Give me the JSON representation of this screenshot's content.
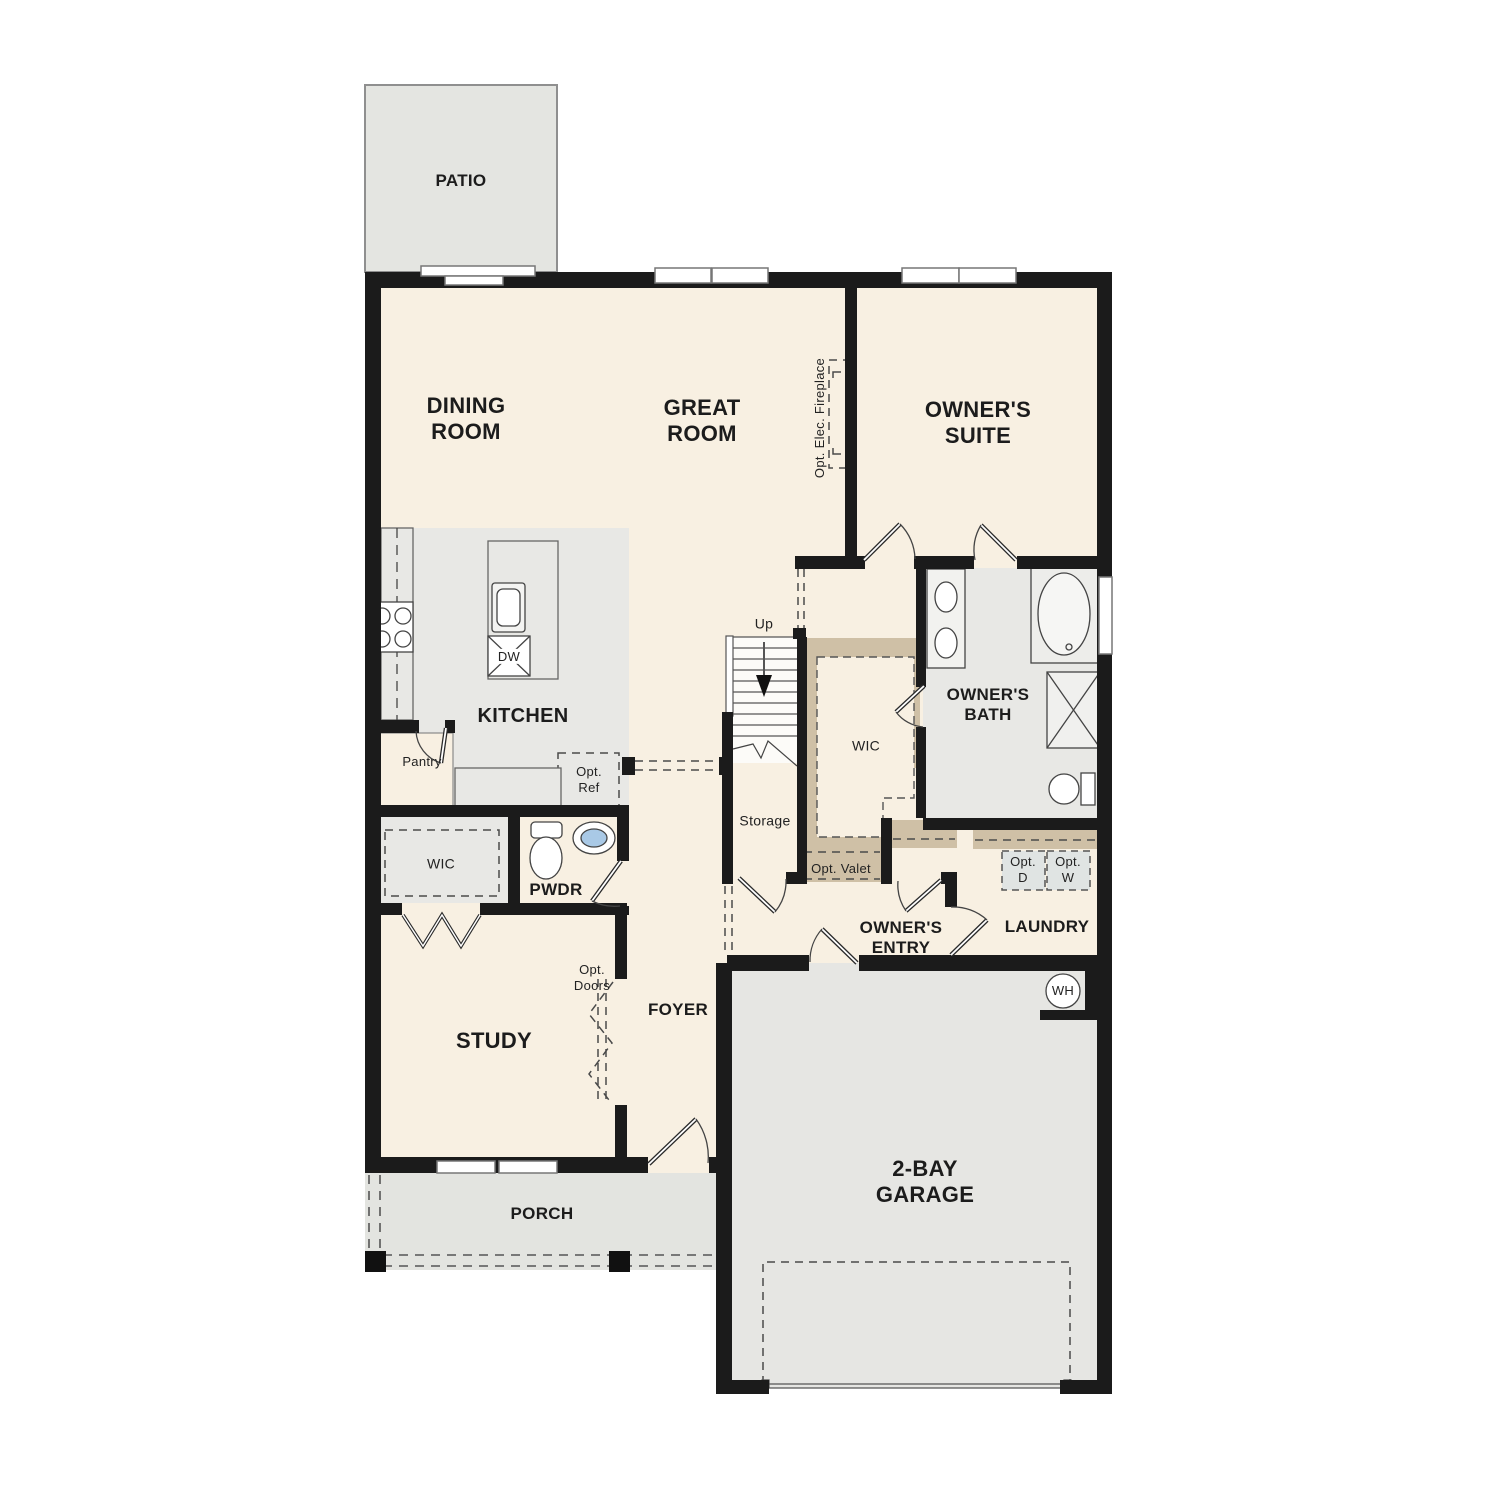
{
  "colors": {
    "wall": "#1b1b1b",
    "floor_main": "#f8f0e2",
    "floor_gray": "#e8e8e5",
    "floor_garage": "#e6e6e3",
    "floor_porch": "#e3e4e0",
    "floor_patio": "#e4e5e1",
    "closet_tan": "#cfc0a6",
    "appliance_box": "#e0e4e3",
    "sink_blue": "#a9c9e6"
  },
  "labels": {
    "patio": "PATIO",
    "dining_room": "DINING\nROOM",
    "great_room": "GREAT\nROOM",
    "owners_suite": "OWNER'S\nSUITE",
    "opt_elec_fireplace": "Opt. Elec. Fireplace",
    "kitchen": "KITCHEN",
    "dw": "DW",
    "pantry": "Pantry",
    "opt_ref": "Opt.\nRef",
    "up": "Up",
    "storage": "Storage",
    "wic_owner": "WIC",
    "opt_valet": "Opt. Valet",
    "owners_bath": "OWNER'S\nBATH",
    "wic_study": "WIC",
    "pwdr": "PWDR",
    "opt_doors": "Opt.\nDoors",
    "study": "STUDY",
    "foyer": "FOYER",
    "owners_entry": "OWNER'S\nENTRY",
    "laundry": "LAUNDRY",
    "opt_d": "Opt.\nD",
    "opt_w": "Opt.\nW",
    "wh": "WH",
    "garage": "2-BAY\nGARAGE",
    "porch": "PORCH"
  }
}
